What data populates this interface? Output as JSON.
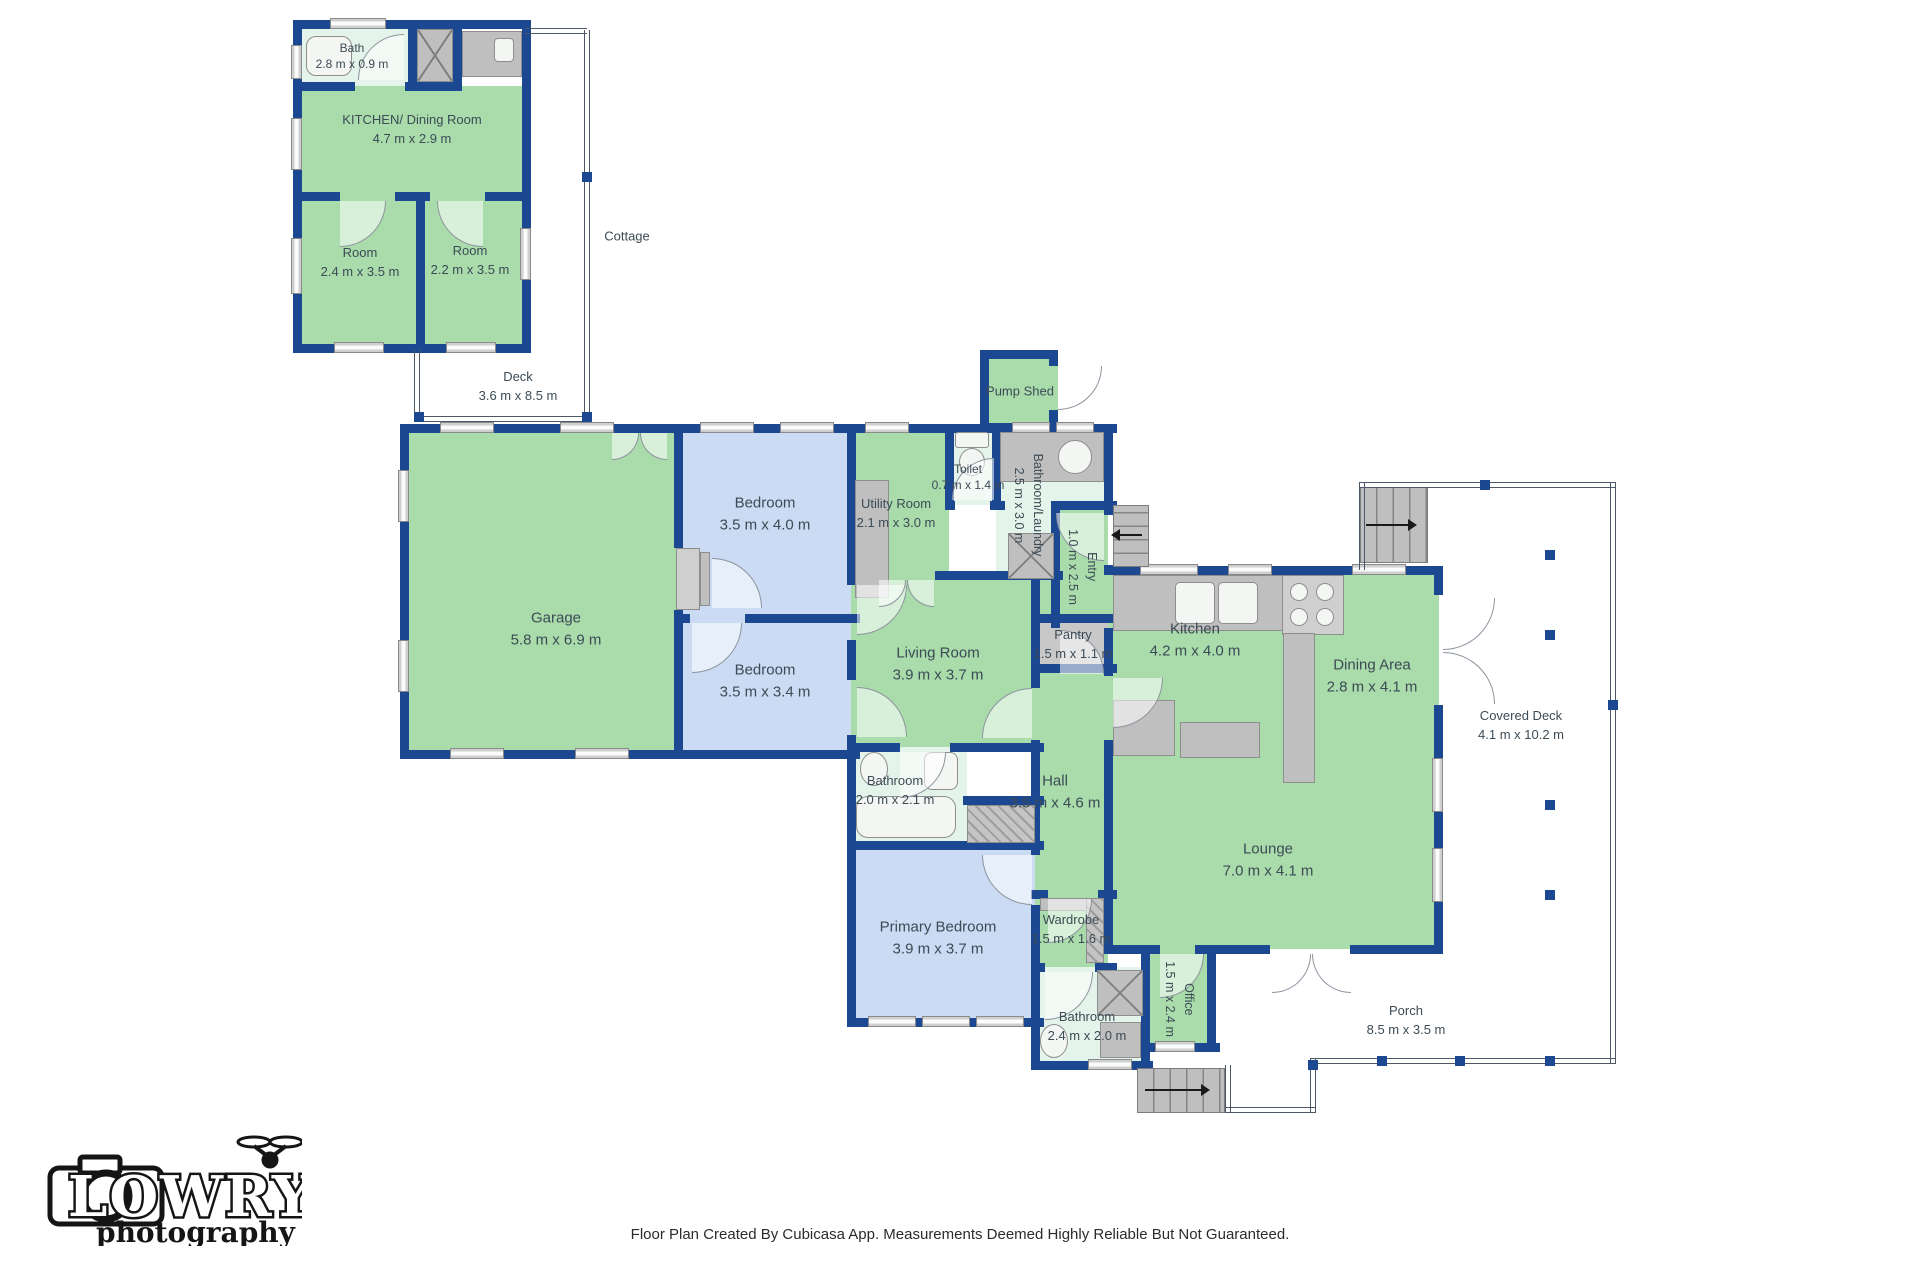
{
  "colors": {
    "wall": "#1c4892",
    "room_green": "#a9dbab",
    "room_blue": "#cadbf3",
    "room_mint": "#e4f4ea",
    "closet_gray": "#c8c8c8",
    "fixture": "#c0bfbf",
    "deck_line": "#4d5866",
    "text": "#3c4b55"
  },
  "logo": {
    "brand": "LOWRY",
    "sub": "photography"
  },
  "footer": {
    "disclaimer": "Floor Plan Created By Cubicasa App. Measurements Deemed Highly Reliable But Not Guaranteed."
  },
  "outdoor": {
    "cottage_label": "Cottage",
    "deck": {
      "name": "Deck",
      "dims": "3.6 m x 8.5 m"
    },
    "covered_deck": {
      "name": "Covered Deck",
      "dims": "4.1 m x 10.2 m"
    },
    "porch": {
      "name": "Porch",
      "dims": "8.5 m x 3.5 m"
    },
    "pump_shed": {
      "name": "Pump Shed"
    }
  },
  "cottage_rooms": {
    "bath": {
      "name": "Bath",
      "dims": "2.8 m x 0.9 m"
    },
    "kitchen_dining": {
      "name": "KITCHEN/ Dining Room",
      "dims": "4.7 m x 2.9 m"
    },
    "room1": {
      "name": "Room",
      "dims": "2.4 m x 3.5 m"
    },
    "room2": {
      "name": "Room",
      "dims": "2.2 m x 3.5 m"
    }
  },
  "rooms": {
    "garage": {
      "name": "Garage",
      "dims": "5.8 m x 6.9 m"
    },
    "bedroom1": {
      "name": "Bedroom",
      "dims": "3.5 m x 4.0 m"
    },
    "bedroom2": {
      "name": "Bedroom",
      "dims": "3.5 m x 3.4 m"
    },
    "utility": {
      "name": "Utility Room",
      "dims": "2.1 m x 3.0 m"
    },
    "toilet": {
      "name": "Toilet",
      "dims": "0.7 m x 1.4 m"
    },
    "bathroom_laundry": {
      "name": "Bathroom/Laundry",
      "dims": "2.5 m x 3.0 m"
    },
    "entry": {
      "name": "Entry",
      "dims": "1.0 m x 2.5 m"
    },
    "living": {
      "name": "Living Room",
      "dims": "3.9 m x 3.7 m"
    },
    "pantry": {
      "name": "Pantry",
      "dims": "1.5 m x 1.1 m"
    },
    "kitchen": {
      "name": "Kitchen",
      "dims": "4.2 m x 4.0 m"
    },
    "dining": {
      "name": "Dining Area",
      "dims": "2.8 m x 4.1 m"
    },
    "hall": {
      "name": "Hall",
      "dims": "3.5 m x 4.6 m"
    },
    "lounge": {
      "name": "Lounge",
      "dims": "7.0 m x 4.1 m"
    },
    "bathroom1": {
      "name": "Bathroom",
      "dims": "2.0 m x 2.1 m"
    },
    "primary": {
      "name": "Primary Bedroom",
      "dims": "3.9 m x 3.7 m"
    },
    "wardrobe": {
      "name": "Wardrobe",
      "dims": "1.5 m x 1.6 m"
    },
    "bathroom2": {
      "name": "Bathroom",
      "dims": "2.4 m x 2.0 m"
    },
    "office": {
      "name": "Office",
      "dims": "1.5 m x 2.4 m"
    }
  }
}
